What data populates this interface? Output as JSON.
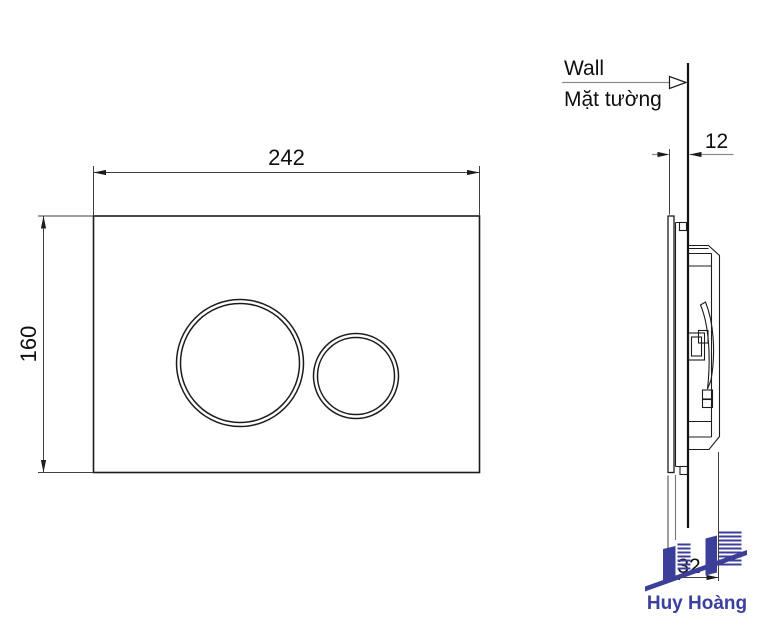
{
  "drawing": {
    "front_view": {
      "width_label": "242",
      "height_label": "160"
    },
    "side_view": {
      "wall_label_en": "Wall",
      "wall_label_vi": "Mặt tường",
      "plate_offset_label": "12",
      "total_depth_label": "32"
    },
    "logo": {
      "brand": "Huy Hoàng",
      "shape_color": "#3c3f99",
      "text_color": "#3b3f9d"
    },
    "colors": {
      "outline": "#1c1c1c",
      "dimension": "#3f3f3f",
      "leader": "#8c8c8c",
      "background": "#ffffff"
    }
  }
}
